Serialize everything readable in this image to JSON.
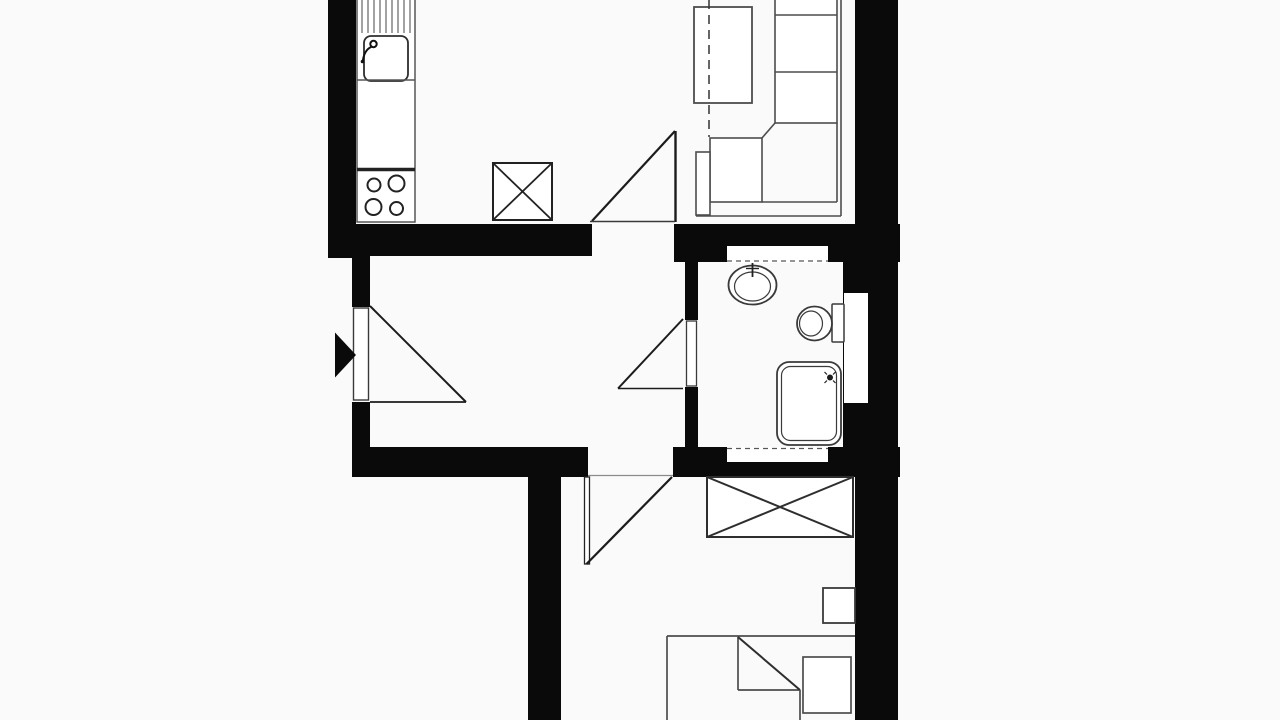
{
  "meta": {
    "title": "apartment-floor-plan",
    "image_type": "black-and-white architectural floor plan, cropped top and bottom",
    "canvas": {
      "width": 1280,
      "height": 720
    }
  },
  "palette": {
    "background": "#fafafa",
    "floor": "#ffffff",
    "wall": "#0a0a0a",
    "furniture": "#4d4d4d",
    "fixture": "#3a3a3a",
    "dark_line": "#1c1c1c"
  },
  "rooms": [
    {
      "name": "kitchen",
      "fixtures": [
        "counter",
        "draining-board",
        "sink",
        "stove-4-burners",
        "shaft-box-x"
      ]
    },
    {
      "name": "living-room",
      "fixtures": [
        "dining-table",
        "section-dashed-line",
        "corner-sofa",
        "door-swing"
      ]
    },
    {
      "name": "hall",
      "fixtures": [
        "entrance-arrow",
        "entrance-door-swing",
        "bathroom-door-swing",
        "bedroom-door-opening"
      ]
    },
    {
      "name": "bathroom",
      "fixtures": [
        "wash-basin-with-tap",
        "toilet-with-cistern",
        "shower-tray",
        "wall-niches",
        "side-recess"
      ]
    },
    {
      "name": "bedroom",
      "fixtures": [
        "wardrobe-x",
        "nightstand",
        "bed-with-folded-blanket",
        "pillow",
        "door-swing"
      ]
    }
  ],
  "geometry": {
    "walls": [
      [
        328,
        0,
        28,
        258,
        "kitchen-left-wall"
      ],
      [
        328,
        224,
        264,
        32,
        "top-wall-left-of-living-door"
      ],
      [
        674,
        224,
        226,
        38,
        "top-wall-above-bathroom"
      ],
      [
        855,
        0,
        43,
        240,
        "living-right-wall"
      ],
      [
        843,
        240,
        55,
        210,
        "bathroom-right-wall"
      ],
      [
        685,
        256,
        13,
        64,
        "bathroom-left-wall-upper"
      ],
      [
        685,
        387,
        13,
        63,
        "bathroom-left-wall-lower"
      ],
      [
        352,
        256,
        18,
        51,
        "hall-left-wall-upper"
      ],
      [
        352,
        402,
        18,
        45,
        "hall-left-wall-lower"
      ],
      [
        352,
        447,
        236,
        30,
        "bottom-wall-left-of-bedroom-door"
      ],
      [
        673,
        447,
        227,
        30,
        "bottom-wall-below-bathroom"
      ],
      [
        528,
        477,
        33,
        243,
        "corridor-left-wall"
      ],
      [
        855,
        450,
        43,
        270,
        "bedroom-right-wall"
      ]
    ],
    "floor_cutouts": [
      [
        727,
        246,
        101,
        17,
        "bathroom-top-niche"
      ],
      [
        844,
        293,
        24,
        110,
        "bathroom-side-recess"
      ],
      [
        727,
        447,
        101,
        15,
        "bathroom-bottom-niche"
      ]
    ],
    "stroke_rects": [
      [
        357,
        -2,
        58,
        224,
        0,
        1.5,
        "#565656",
        "kitchen-counter"
      ],
      [
        364,
        36,
        44,
        45,
        7,
        1.8,
        "#2e2e2e",
        "kitchen-sink"
      ],
      [
        493,
        163,
        59,
        57,
        0,
        2,
        "#222222",
        "shaft-box"
      ],
      [
        694,
        7,
        58,
        96,
        0,
        1.8,
        "#4d4d4d",
        "dining-table"
      ],
      [
        710,
        138,
        52,
        64,
        0,
        1.6,
        "#4d4d4d",
        "sofa-chaise-cushion"
      ],
      [
        696,
        152,
        14,
        63,
        0,
        1.6,
        "#4d4d4d",
        "sofa-armrest"
      ],
      [
        775,
        -3,
        62,
        126,
        0,
        1.6,
        "#4d4d4d",
        "sofa-back-cushions"
      ],
      [
        832,
        304,
        12,
        38,
        1,
        1.5,
        "#3a3a3a",
        "toilet-cistern"
      ],
      [
        777,
        362,
        64,
        83,
        12,
        1.8,
        "#3a3a3a",
        "shower-tray-outer"
      ],
      [
        781.5,
        366.5,
        55,
        74,
        9,
        1.2,
        "#3a3a3a",
        "shower-tray-inner"
      ],
      [
        707,
        477,
        146,
        60,
        0,
        2,
        "#2e2e2e",
        "wardrobe"
      ],
      [
        823,
        588,
        32,
        35,
        0,
        1.8,
        "#3a3a3a",
        "nightstand"
      ],
      [
        803,
        657,
        48,
        56,
        0,
        1.7,
        "#4d4d4d",
        "bed-pillow"
      ],
      [
        353.5,
        308,
        15,
        92,
        0,
        1.4,
        "#3a3a3a",
        "entrance-door-leaf"
      ],
      [
        686.5,
        321,
        10,
        65,
        0,
        1.3,
        "#3a3a3a",
        "bathroom-door-leaf"
      ],
      [
        584.5,
        477,
        5,
        87,
        0,
        1.3,
        "#222222",
        "bedroom-door-leaf"
      ]
    ],
    "ellipses": [
      [
        752.5,
        285,
        24,
        19.5,
        1.8,
        "#3a3a3a",
        "basin-outer"
      ],
      [
        752.5,
        286.5,
        18,
        14.5,
        1.2,
        "#3a3a3a",
        "basin-inner"
      ],
      [
        814.5,
        323.5,
        17.5,
        17,
        1.8,
        "#3a3a3a",
        "toilet-bowl-outer"
      ],
      [
        811,
        323.5,
        11.5,
        12.5,
        1.2,
        "#3a3a3a",
        "toilet-bowl-inner"
      ]
    ],
    "circles": [
      [
        373.5,
        44,
        3.2,
        2,
        "s",
        "#111111",
        "faucet-knob"
      ],
      [
        362.5,
        61.5,
        1.8,
        0,
        "f",
        "#111111",
        "faucet-spout-tip"
      ],
      [
        374,
        185,
        6.5,
        2,
        "s",
        "#222222",
        "stove-burner-1"
      ],
      [
        396.5,
        183.5,
        8,
        2,
        "s",
        "#222222",
        "stove-burner-2"
      ],
      [
        373.5,
        207,
        8,
        2,
        "s",
        "#222222",
        "stove-burner-3"
      ],
      [
        396.5,
        208.5,
        6.5,
        2,
        "s",
        "#222222",
        "stove-burner-4"
      ],
      [
        830,
        377.5,
        3,
        0,
        "f",
        "#1c1c1c",
        "shower-head"
      ]
    ],
    "lines": [
      [
        362,
        -2,
        362,
        33,
        1.1,
        "",
        "#565656",
        "drainer-groove-1"
      ],
      [
        368,
        -2,
        368,
        33,
        1.1,
        "",
        "#565656",
        "drainer-groove-2"
      ],
      [
        374,
        -2,
        374,
        33,
        1.1,
        "",
        "#565656",
        "drainer-groove-3"
      ],
      [
        380,
        -2,
        380,
        33,
        1.1,
        "",
        "#565656",
        "drainer-groove-4"
      ],
      [
        386,
        -2,
        386,
        33,
        1.1,
        "",
        "#565656",
        "drainer-groove-5"
      ],
      [
        392,
        -2,
        392,
        33,
        1.1,
        "",
        "#565656",
        "drainer-groove-6"
      ],
      [
        398,
        -2,
        398,
        33,
        1.1,
        "",
        "#565656",
        "drainer-groove-7"
      ],
      [
        404,
        -2,
        404,
        33,
        1.1,
        "",
        "#565656",
        "drainer-groove-8"
      ],
      [
        410,
        -2,
        410,
        33,
        1.1,
        "",
        "#565656",
        "drainer-groove-9"
      ],
      [
        357,
        80,
        415,
        80,
        1.4,
        "",
        "#565656",
        "counter-divider"
      ],
      [
        357,
        169.5,
        415,
        169.5,
        3.5,
        "",
        "#222222",
        "stove-front-edge"
      ],
      [
        709,
        0,
        709,
        137,
        1.5,
        "9 6",
        "#333333",
        "section-dashed-line"
      ],
      [
        775,
        15,
        837,
        15,
        1.6,
        "",
        "#4d4d4d",
        "sofa-cushion-divider-1"
      ],
      [
        775,
        72,
        837,
        72,
        1.6,
        "",
        "#4d4d4d",
        "sofa-cushion-divider-2"
      ],
      [
        775,
        123,
        762,
        138,
        1.6,
        "",
        "#4d4d4d",
        "sofa-corner-diagonal"
      ],
      [
        762,
        202,
        837,
        202,
        1.6,
        "",
        "#4d4d4d",
        "sofa-seat-bottom-inner"
      ],
      [
        837,
        123,
        837,
        202,
        1.6,
        "",
        "#4d4d4d",
        "sofa-back-inner"
      ],
      [
        841,
        -3,
        841,
        216,
        1.6,
        "",
        "#4d4d4d",
        "sofa-outer-right"
      ],
      [
        696,
        216,
        841,
        216,
        1.6,
        "",
        "#4d4d4d",
        "sofa-outer-bottom"
      ],
      [
        592,
        221,
        675,
        131,
        2.2,
        "",
        "#1c1c1c",
        "living-door-swing-chord"
      ],
      [
        675.5,
        131,
        675.5,
        222,
        2.4,
        "",
        "#1c1c1c",
        "living-door-leaf"
      ],
      [
        590,
        221.5,
        675,
        221.5,
        1.4,
        "",
        "#3a3a3a",
        "living-door-threshold"
      ],
      [
        370,
        306,
        466,
        402,
        2,
        "",
        "#1c1c1c",
        "entrance-door-swing-chord"
      ],
      [
        370,
        402,
        466,
        402,
        1.7,
        "",
        "#1c1c1c",
        "entrance-door-base"
      ],
      [
        683,
        319,
        618,
        388.5,
        2,
        "",
        "#1c1c1c",
        "bathroom-door-swing-chord"
      ],
      [
        618,
        388.5,
        683,
        388.5,
        1.6,
        "",
        "#1c1c1c",
        "bathroom-door-base"
      ],
      [
        672,
        477,
        586.5,
        564,
        2.2,
        "",
        "#1c1c1c",
        "bedroom-door-swing-chord"
      ],
      [
        588,
        475.5,
        673,
        475.5,
        1.2,
        "",
        "#8a8a8a",
        "bedroom-door-threshold"
      ],
      [
        727,
        261,
        828,
        261,
        1.3,
        "5 4",
        "#565656",
        "top-niche-dashes"
      ],
      [
        727,
        448.5,
        828,
        448.5,
        1.3,
        "5 4",
        "#565656",
        "bottom-niche-dashes"
      ],
      [
        752.5,
        263,
        752.5,
        277,
        1.8,
        "",
        "#222222",
        "basin-tap-stem"
      ],
      [
        746,
        268.5,
        759,
        268.5,
        1.4,
        "",
        "#222222",
        "basin-tap-bar"
      ],
      [
        707,
        477,
        853,
        537,
        2,
        "",
        "#2e2e2e",
        "wardrobe-diagonal-1"
      ],
      [
        707,
        537,
        853,
        477,
        2,
        "",
        "#2e2e2e",
        "wardrobe-diagonal-2"
      ],
      [
        493,
        163,
        552,
        220,
        1.8,
        "",
        "#222222",
        "shaft-diagonal-1"
      ],
      [
        493,
        220,
        552,
        163,
        1.8,
        "",
        "#222222",
        "shaft-diagonal-2"
      ],
      [
        667,
        636,
        855,
        636,
        1.7,
        "",
        "#4d4d4d",
        "bed-head-edge"
      ],
      [
        667,
        636,
        667,
        720,
        1.7,
        "",
        "#4d4d4d",
        "bed-left-edge"
      ],
      [
        738,
        637,
        738,
        690,
        1.7,
        "",
        "#4d4d4d",
        "blanket-fold-left"
      ],
      [
        738,
        690,
        800,
        690,
        1.7,
        "",
        "#4d4d4d",
        "blanket-fold-bottom"
      ],
      [
        738,
        637,
        800,
        690,
        2,
        "",
        "#2e2e2e",
        "blanket-fold-diagonal"
      ],
      [
        800,
        690,
        800,
        720,
        1.7,
        "",
        "#4d4d4d",
        "bed-right-edge"
      ],
      [
        824.5,
        372,
        827,
        374.5,
        1.2,
        "",
        "#222222",
        "shower-spray-tick-1"
      ],
      [
        833,
        380.5,
        835.5,
        383,
        1.2,
        "",
        "#222222",
        "shower-spray-tick-2"
      ],
      [
        824.5,
        383,
        827,
        380.5,
        1.2,
        "",
        "#222222",
        "shower-spray-tick-3"
      ],
      [
        833,
        374.5,
        835.5,
        372,
        1.2,
        "",
        "#222222",
        "shower-spray-tick-4"
      ]
    ],
    "paths": [
      [
        "M371,47 C367,49 364,53 363,60",
        2,
        "#111111",
        "faucet-spout"
      ]
    ],
    "polygons": [
      [
        "335,332.5 356,355 335,377.5",
        "#0a0a0a",
        "entrance-arrow"
      ]
    ]
  }
}
